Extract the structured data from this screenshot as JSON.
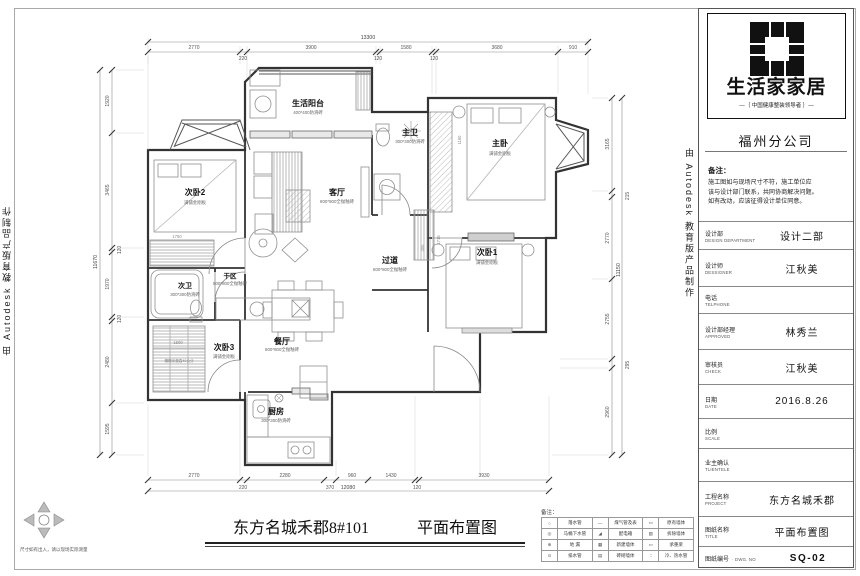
{
  "watermark": {
    "text_left": "由 Autodesk 教育版产品制作",
    "text_right": "由 Autodesk 教育版产品制作"
  },
  "sheet": {
    "project_title": "东方名城禾郡8#101",
    "drawing_title": "平面布置图",
    "corner_note": "尺寸如有出入，请以现场实际测量"
  },
  "plan": {
    "rooms": [
      {
        "name": "次卧2",
        "material": "满铺金刚板"
      },
      {
        "name": "生活阳台",
        "material": "400*400防滑砖"
      },
      {
        "name": "客厅",
        "material": "800*800全抛釉砖"
      },
      {
        "name": "主卫",
        "material": "300*300防滑砖"
      },
      {
        "name": "主卧",
        "material": "满铺金刚板"
      },
      {
        "name": "次卧1",
        "material": "满铺金刚板"
      },
      {
        "name": "过道",
        "material": "800*800全抛釉砖"
      },
      {
        "name": "干区",
        "material": "800*800全抛釉砖"
      },
      {
        "name": "次卫",
        "material": "300*300防滑砖"
      },
      {
        "name": "次卧3",
        "material": "满铺金刚板"
      },
      {
        "name": "餐厅",
        "material": "800*800全抛釉砖"
      },
      {
        "name": "厨房",
        "material": "300*300防滑砖"
      }
    ],
    "annotation_tatami": "榻榻米垫高40公分",
    "dims": {
      "top": {
        "overall": "13300",
        "segs": [
          "2770",
          "220",
          "3900",
          "120",
          "1580",
          "120",
          "3680",
          "910"
        ]
      },
      "bottom": {
        "overall": "12080",
        "segs": [
          "2770",
          "220",
          "2280",
          "370",
          "960",
          "1430",
          "120",
          "3930"
        ]
      },
      "left": {
        "overall": "11670",
        "segs": [
          "1920",
          "3465",
          "120",
          "1970",
          "120",
          "2480",
          "1595"
        ]
      },
      "right": {
        "overall": "11150",
        "segs": [
          "3165",
          "215",
          "2770",
          "2755",
          "295",
          "2960"
        ]
      },
      "inner": [
        "1750",
        "1160",
        "305",
        "1715",
        "1500"
      ]
    }
  },
  "legend": {
    "caption": "备注：",
    "rows": [
      {
        "s1": "○",
        "l1": "落水管",
        "s2": "—",
        "l2": "煤气管及表",
        "s3": "▭",
        "l3": "原有墙体"
      },
      {
        "s1": "◎",
        "l1": "马桶下水管",
        "s2": "◢",
        "l2": "配电箱",
        "s3": "▨",
        "l3": "拆除墙体"
      },
      {
        "s1": "⊕",
        "l1": "地 漏",
        "s2": "▦",
        "l2": "新建墙体",
        "s3": "▭",
        "l3": "承重梁"
      },
      {
        "s1": "⊙",
        "l1": "排水管",
        "s2": "▤",
        "l2": "砖砌墙体",
        "s3": "∶∶",
        "l3": "冷、热水管"
      }
    ]
  },
  "title_block": {
    "brand": {
      "name": "生活家家居",
      "tagline": "—｛ 中国健康整装领导者 ｝—",
      "branch": "福州分公司"
    },
    "notes": {
      "caption": "备注：",
      "lines": [
        "施工图如与现场尺寸不符，施工单位应",
        "该与设计部门联系，共同协商解决问题。",
        "如有改动，应该征得设计单位同意。"
      ]
    },
    "rows": [
      {
        "cn": "设计部",
        "en": "DESIGN DEPARTMENT",
        "value": "设计二部"
      },
      {
        "cn": "设计师",
        "en": "DESSIGNER",
        "value": "江秋美"
      },
      {
        "cn": "电话",
        "en": "TELPHONE",
        "value": ""
      },
      {
        "cn": "设计部经理",
        "en": "APPROVED",
        "value": "林秀兰"
      },
      {
        "cn": "审核员",
        "en": "CHECK",
        "value": "江秋美"
      },
      {
        "cn": "日期",
        "en": "DATE",
        "value": "2016.8.26"
      },
      {
        "cn": "比例",
        "en": "SCALE",
        "value": ""
      },
      {
        "cn": "业主确认",
        "en": "TLIENTELE",
        "value": ""
      },
      {
        "cn": "工程名称",
        "en": "PROJECT",
        "value": "东方名城禾郡"
      },
      {
        "cn": "图纸名称",
        "en": "TITLE",
        "value": "平面布置图"
      },
      {
        "cn": "图纸编号",
        "en": "· DWG. NO",
        "value": "SQ-02"
      }
    ]
  }
}
